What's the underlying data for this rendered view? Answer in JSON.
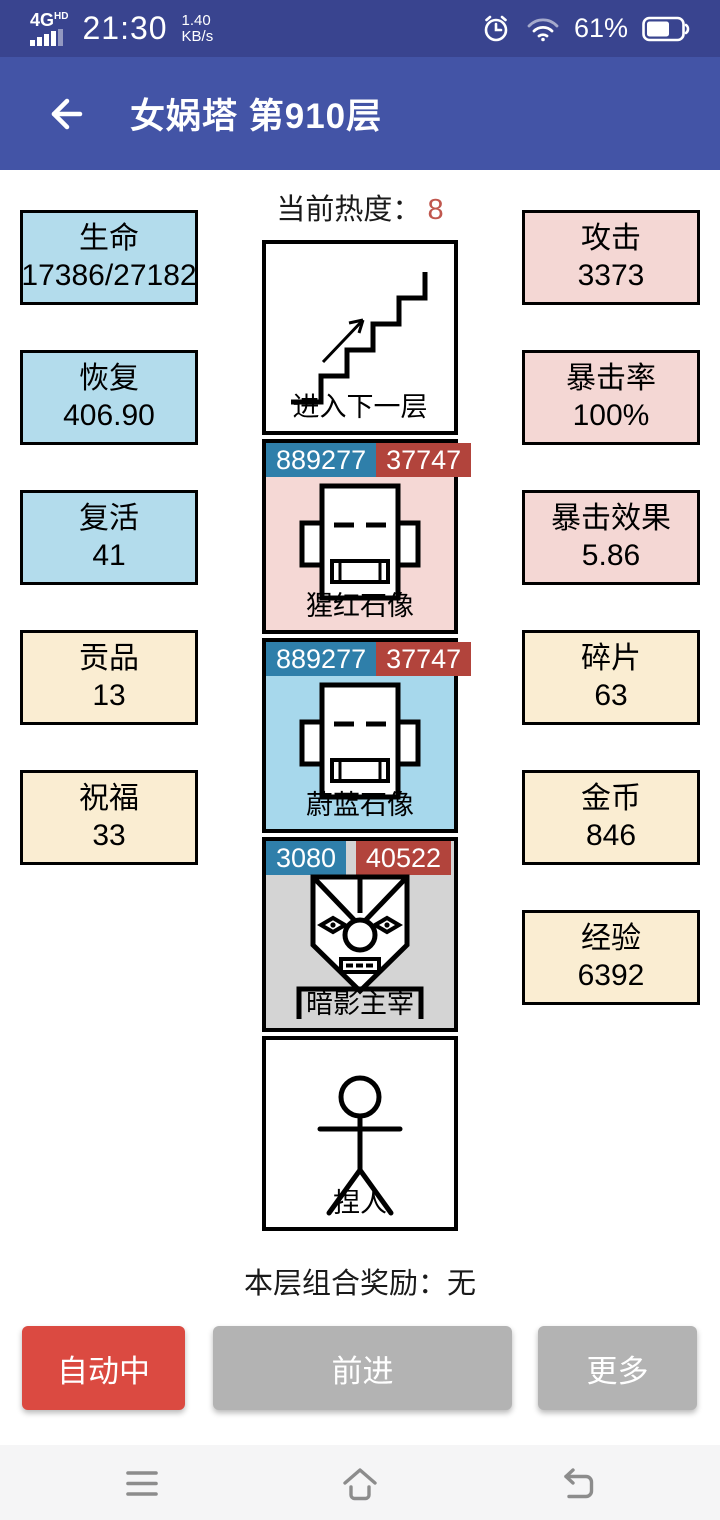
{
  "status_bar": {
    "network": "4G",
    "network_badge": "HD",
    "time": "21:30",
    "net_speed_value": "1.40",
    "net_speed_unit": "KB/s",
    "battery_percent": "61%"
  },
  "app_bar": {
    "title": "女娲塔 第910层"
  },
  "main": {
    "heat_label": "当前热度：",
    "heat_value": "8",
    "combo_label": "本层组合奖励：",
    "combo_value": "无"
  },
  "left_stats": [
    {
      "label": "生命",
      "value": "17386/27182"
    },
    {
      "label": "恢复",
      "value": "406.90"
    },
    {
      "label": "复活",
      "value": "41"
    },
    {
      "label": "贡品",
      "value": "13"
    },
    {
      "label": "祝福",
      "value": "33"
    }
  ],
  "right_stats": [
    {
      "label": "攻击",
      "value": "3373"
    },
    {
      "label": "暴击率",
      "value": "100%"
    },
    {
      "label": "暴击效果",
      "value": "5.86"
    },
    {
      "label": "碎片",
      "value": "63"
    },
    {
      "label": "金币",
      "value": "846"
    },
    {
      "label": "经验",
      "value": "6392"
    }
  ],
  "tower": {
    "next_floor_label": "进入下一层",
    "monsters": [
      {
        "name": "猩红石像",
        "hp": "889277",
        "attack": "37747"
      },
      {
        "name": "蔚蓝石像",
        "hp": "889277",
        "attack": "37747"
      },
      {
        "name": "暗影主宰",
        "hp": "3080",
        "attack": "40522"
      }
    ],
    "player_label": "捏人"
  },
  "actions": [
    {
      "label": "自动中"
    },
    {
      "label": "前进"
    },
    {
      "label": "更多"
    }
  ],
  "icons": [
    "signal-bars-icon",
    "alarm-clock-icon",
    "wifi-icon",
    "battery-icon",
    "back-arrow-icon",
    "stairs-up-icon",
    "statue-face-icon",
    "demon-face-icon",
    "stick-figure-icon",
    "nav-menu-icon",
    "nav-home-icon",
    "nav-return-icon"
  ],
  "colors": {
    "status_bar_bg": "#39448F",
    "app_bar_bg": "#4354A6",
    "stat_blue": "#B3DCEC",
    "stat_cream": "#FAEDD2",
    "stat_pink": "#F4D7D4",
    "card_pink": "#F5D8D5",
    "card_blue": "#A7D8EC",
    "card_gray": "#D4D4D4",
    "badge_hp_blue": "#2F7FAA",
    "badge_attack_red": "#B2443C",
    "heat_value_red": "#C0574E",
    "auto_button_red": "#DB4A41",
    "secondary_button_gray": "#B3B3B3"
  }
}
